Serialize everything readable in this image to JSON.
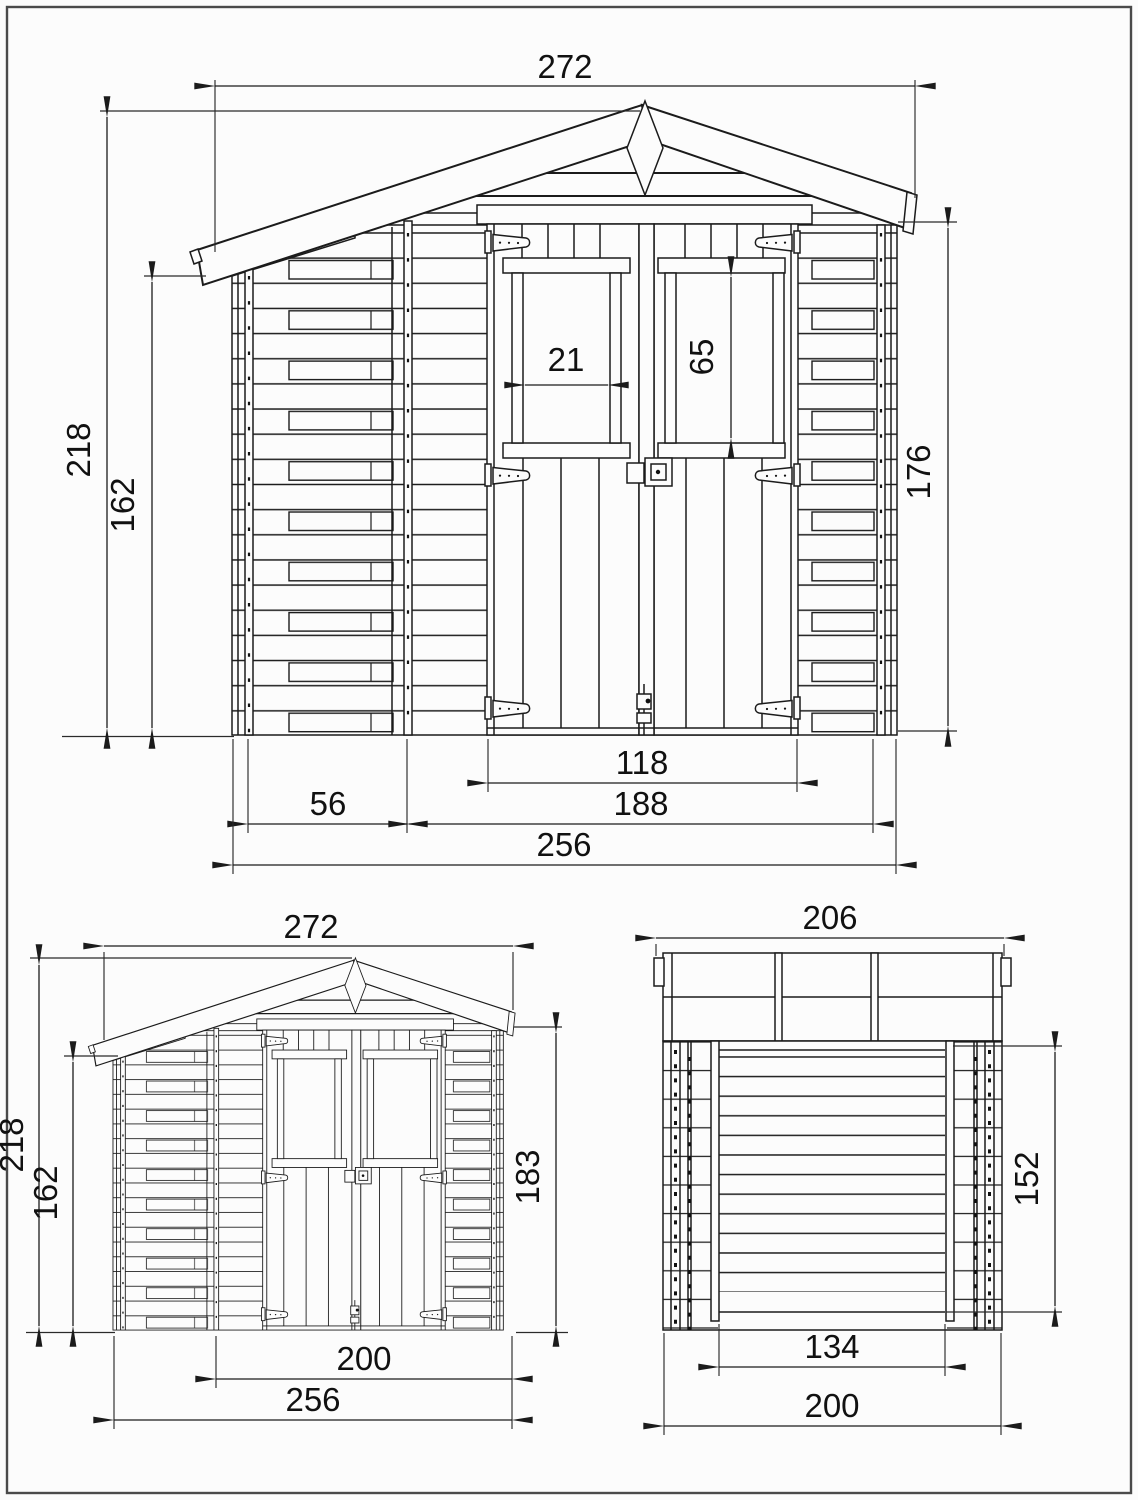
{
  "drawing": {
    "front_view": {
      "roof_width": "272",
      "total_height": "218",
      "eaves_height": "162",
      "window_width": "21",
      "window_height": "65",
      "wall_height": "176",
      "door_width": "118",
      "side_section": "56",
      "front_section": "188",
      "base_width": "256"
    },
    "front_small_view": {
      "roof_width": "272",
      "total_height": "218",
      "eaves_height": "162",
      "wall_height": "183",
      "inner_width": "200",
      "base_width": "256"
    },
    "rear_view": {
      "roof_width": "206",
      "wall_height": "152",
      "inner_width": "134",
      "base_width": "200"
    }
  }
}
